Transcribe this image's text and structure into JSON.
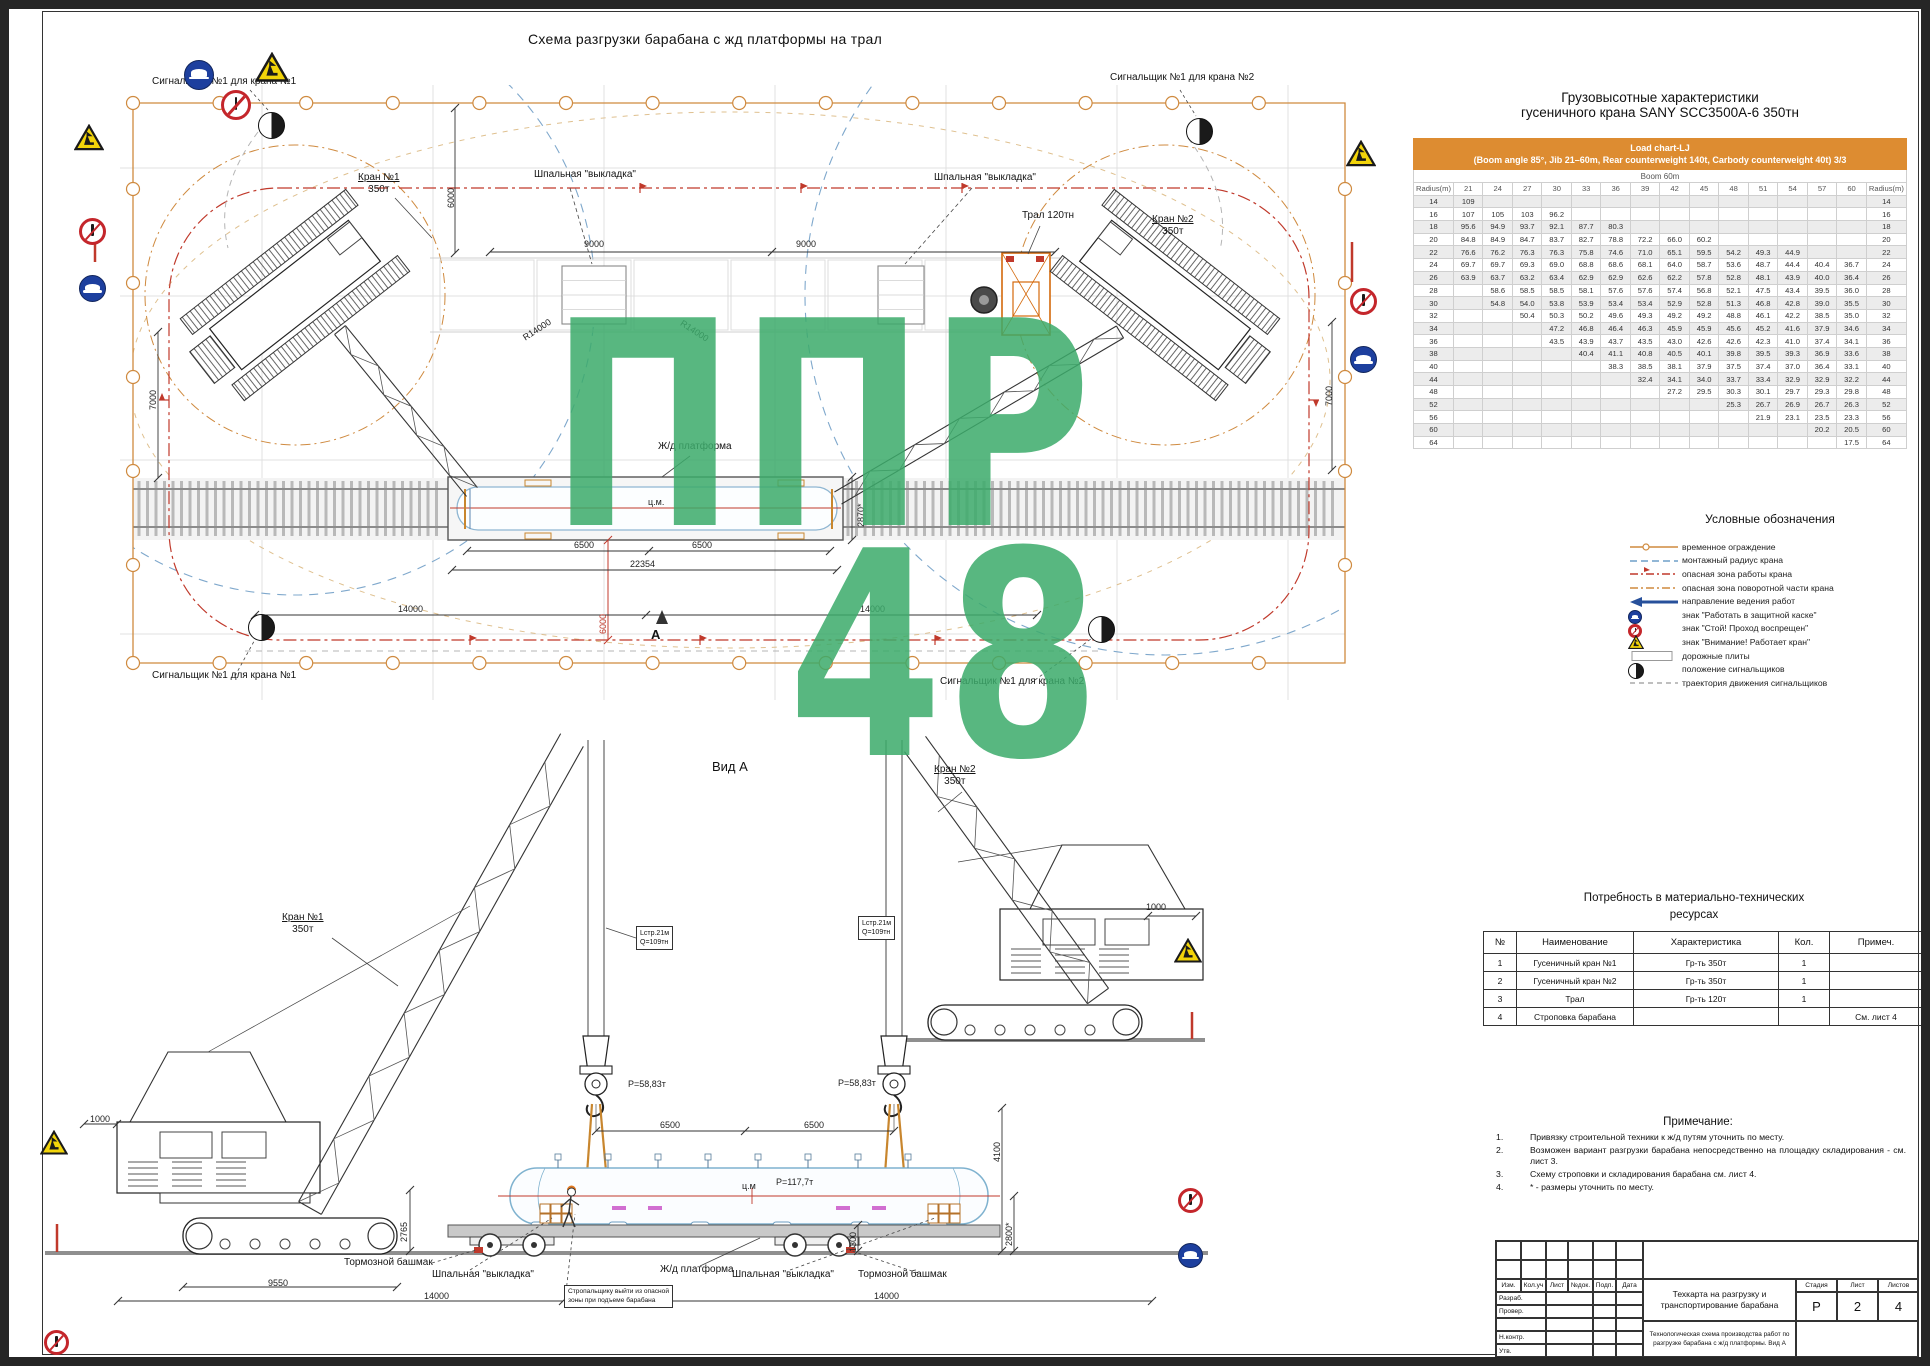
{
  "title": "Схема разгрузки барабана с жд платформы на трал",
  "watermark": {
    "line1": "ППР",
    "line2": "48"
  },
  "plan": {
    "signalman_crane1_top": "Сигнальщик №1 для крана №1",
    "signalman_crane2_top": "Сигнальщик №1 для крана №2",
    "signalman_crane1_bottom": "Сигнальщик №1 для крана №1",
    "signalman_crane2_bottom": "Сигнальщик №1 для крана №2",
    "crane1_line1": "Кран №1",
    "crane1_line2": "350т",
    "crane2_line1": "Кран №2",
    "crane2_line2": "350т",
    "sleeper_label": "Шпальная \"выкладка\"",
    "tral_label": "Трал 120тн",
    "platform_label": "Ж/д платформа",
    "cm_label": "ц.м.",
    "section_marker": "А",
    "dims": {
      "d6000": "6000",
      "d9000": "9000",
      "d7000": "7000",
      "r14000": "R14000",
      "d14000": "14000",
      "d6500": "6500",
      "d22354": "22354",
      "d2870": "2870*",
      "d6000red": "6000"
    }
  },
  "view_a": {
    "title": "Вид А",
    "crane1_line1": "Кран №1",
    "crane1_line2": "350т",
    "crane2_line1": "Кран №2",
    "crane2_line2": "350т",
    "hook_load": "Р=58,83т",
    "sling_line1": "Lстр.21м",
    "sling_line2": "Q=109тн",
    "drum_weight": "Р=117,7т",
    "drum_cm": "ц.м",
    "brake_shoe": "Тормозной башмак",
    "sleeper": "Шпальная \"выкладка\"",
    "platform": "Ж/д платформа",
    "callout_line1": "Стропальщику выйти из опасной",
    "callout_line2": "зоны при подъеме барабана",
    "dims": {
      "d6500": "6500",
      "d4100": "4100",
      "d2800": "2800*",
      "d1300": "1300",
      "d1000": "1000",
      "d2765": "2765",
      "d9550": "9550",
      "d14000": "14000"
    }
  },
  "load_chart": {
    "title_line1": "Грузовысотные характеристики",
    "title_line2": "гусеничного крана SANY SCC3500A-6 350тн",
    "header_line1": "Load chart-LJ",
    "header_line2": "(Boom angle 85°, Jib 21–60m, Rear counterweight 140t, Carbody counterweight 40t) 3/3",
    "boom_label": "Boom 60m",
    "radius_label": "Radius(m)",
    "columns": [
      "21",
      "24",
      "27",
      "30",
      "33",
      "36",
      "39",
      "42",
      "45",
      "48",
      "51",
      "54",
      "57",
      "60"
    ],
    "rows": [
      {
        "radius": "14",
        "values": [
          "109",
          "",
          "",
          "",
          "",
          "",
          "",
          "",
          "",
          "",
          "",
          "",
          "",
          ""
        ]
      },
      {
        "radius": "16",
        "values": [
          "107",
          "105",
          "103",
          "96.2",
          "",
          "",
          "",
          "",
          "",
          "",
          "",
          "",
          "",
          ""
        ]
      },
      {
        "radius": "18",
        "values": [
          "95.6",
          "94.9",
          "93.7",
          "92.1",
          "87.7",
          "80.3",
          "",
          "",
          "",
          "",
          "",
          "",
          "",
          ""
        ]
      },
      {
        "radius": "20",
        "values": [
          "84.8",
          "84.9",
          "84.7",
          "83.7",
          "82.7",
          "78.8",
          "72.2",
          "66.0",
          "60.2",
          "",
          "",
          "",
          "",
          ""
        ]
      },
      {
        "radius": "22",
        "values": [
          "76.6",
          "76.2",
          "76.3",
          "76.3",
          "75.8",
          "74.6",
          "71.0",
          "65.1",
          "59.5",
          "54.2",
          "49.3",
          "44.9",
          "",
          ""
        ]
      },
      {
        "radius": "24",
        "values": [
          "69.7",
          "69.7",
          "69.3",
          "69.0",
          "68.8",
          "68.6",
          "68.1",
          "64.0",
          "58.7",
          "53.6",
          "48.7",
          "44.4",
          "40.4",
          "36.7"
        ]
      },
      {
        "radius": "26",
        "values": [
          "63.9",
          "63.7",
          "63.2",
          "63.4",
          "62.9",
          "62.9",
          "62.6",
          "62.2",
          "57.8",
          "52.8",
          "48.1",
          "43.9",
          "40.0",
          "36.4"
        ]
      },
      {
        "radius": "28",
        "values": [
          "",
          "58.6",
          "58.5",
          "58.5",
          "58.1",
          "57.6",
          "57.6",
          "57.4",
          "56.8",
          "52.1",
          "47.5",
          "43.4",
          "39.5",
          "36.0"
        ]
      },
      {
        "radius": "30",
        "values": [
          "",
          "54.8",
          "54.0",
          "53.8",
          "53.9",
          "53.4",
          "53.4",
          "52.9",
          "52.8",
          "51.3",
          "46.8",
          "42.8",
          "39.0",
          "35.5"
        ]
      },
      {
        "radius": "32",
        "values": [
          "",
          "",
          "50.4",
          "50.3",
          "50.2",
          "49.6",
          "49.3",
          "49.2",
          "49.2",
          "48.8",
          "46.1",
          "42.2",
          "38.5",
          "35.0"
        ]
      },
      {
        "radius": "34",
        "values": [
          "",
          "",
          "",
          "47.2",
          "46.8",
          "46.4",
          "46.3",
          "45.9",
          "45.9",
          "45.6",
          "45.2",
          "41.6",
          "37.9",
          "34.6"
        ]
      },
      {
        "radius": "36",
        "values": [
          "",
          "",
          "",
          "43.5",
          "43.9",
          "43.7",
          "43.5",
          "43.0",
          "42.6",
          "42.6",
          "42.3",
          "41.0",
          "37.4",
          "34.1"
        ]
      },
      {
        "radius": "38",
        "values": [
          "",
          "",
          "",
          "",
          "40.4",
          "41.1",
          "40.8",
          "40.5",
          "40.1",
          "39.8",
          "39.5",
          "39.3",
          "36.9",
          "33.6"
        ]
      },
      {
        "radius": "40",
        "values": [
          "",
          "",
          "",
          "",
          "",
          "38.3",
          "38.5",
          "38.1",
          "37.9",
          "37.5",
          "37.4",
          "37.0",
          "36.4",
          "33.1"
        ]
      },
      {
        "radius": "44",
        "values": [
          "",
          "",
          "",
          "",
          "",
          "",
          "32.4",
          "34.1",
          "34.0",
          "33.7",
          "33.4",
          "32.9",
          "32.9",
          "32.2"
        ]
      },
      {
        "radius": "48",
        "values": [
          "",
          "",
          "",
          "",
          "",
          "",
          "",
          "27.2",
          "29.5",
          "30.3",
          "30.1",
          "29.7",
          "29.3",
          "29.8"
        ]
      },
      {
        "radius": "52",
        "values": [
          "",
          "",
          "",
          "",
          "",
          "",
          "",
          "",
          "",
          "25.3",
          "26.7",
          "26.9",
          "26.7",
          "26.3"
        ]
      },
      {
        "radius": "56",
        "values": [
          "",
          "",
          "",
          "",
          "",
          "",
          "",
          "",
          "",
          "",
          "21.9",
          "23.1",
          "23.5",
          "23.3"
        ]
      },
      {
        "radius": "60",
        "values": [
          "",
          "",
          "",
          "",
          "",
          "",
          "",
          "",
          "",
          "",
          "",
          "",
          "20.2",
          "20.5"
        ]
      },
      {
        "radius": "64",
        "values": [
          "",
          "",
          "",
          "",
          "",
          "",
          "",
          "",
          "",
          "",
          "",
          "",
          "",
          "17.5"
        ]
      }
    ]
  },
  "legend": {
    "title": "Условные обозначения",
    "items": [
      {
        "icon": "fence-line-icon",
        "label": "временное ограждение"
      },
      {
        "icon": "blue-dash-icon",
        "label": "монтажный радиус крана"
      },
      {
        "icon": "red-dashdot-icon",
        "label": "опасная зона работы крана"
      },
      {
        "icon": "orange-dashdot-icon",
        "label": "опасная зона поворотной части крана"
      },
      {
        "icon": "direction-arrow-icon",
        "label": "направление ведения работ"
      },
      {
        "icon": "helmet-sign-icon",
        "label": "знак \"Работать в защитной каске\""
      },
      {
        "icon": "stop-sign-icon",
        "label": "знак \"Стой! Проход воспрещен\""
      },
      {
        "icon": "crane-warning-sign-icon",
        "label": "знак \"Внимание! Работает кран\""
      },
      {
        "icon": "road-plate-icon",
        "label": "дорожные плиты"
      },
      {
        "icon": "signalman-icon",
        "label": "положение сигнальщиков"
      },
      {
        "icon": "gray-dash-icon",
        "label": "траектория движения сигнальщиков"
      }
    ]
  },
  "resources": {
    "title_line1": "Потребность в материально-технических",
    "title_line2": "ресурсах",
    "headers": [
      "№",
      "Наименование",
      "Характеристика",
      "Кол.",
      "Примеч."
    ],
    "rows": [
      [
        "1",
        "Гусеничный кран №1",
        "Гр-ть 350т",
        "1",
        ""
      ],
      [
        "2",
        "Гусеничный кран №2",
        "Гр-ть 350т",
        "1",
        ""
      ],
      [
        "3",
        "Трал",
        "Гр-ть 120т",
        "1",
        ""
      ],
      [
        "4",
        "Строповка барабана",
        "",
        "",
        "См. лист 4"
      ]
    ]
  },
  "notes": {
    "title": "Примечание:",
    "items": [
      "Привязку строительной техники к ж/д путям уточнить по месту.",
      "Возможен вариант разгрузки барабана непосредственно на площадку складирования - см. лист 3.",
      "Схему строповки и складирования барабана см. лист 4.",
      "* - размеры уточнить по месту."
    ]
  },
  "titleblock": {
    "cols": [
      "Изм.",
      "Кол.уч",
      "Лист",
      "№док.",
      "Подп.",
      "Дата"
    ],
    "rows": [
      "Разраб.",
      "Провер.",
      "",
      "Н.контр.",
      "Утв."
    ],
    "doc_title": "Техкарта на разгрузку и транспортирование барабана",
    "sheet_title": "Технологическая схема производства работ по разгрузке барабана с ж/д платформы. Вид А",
    "stage_headers": [
      "Стадия",
      "Лист",
      "Листов"
    ],
    "stage_values": [
      "Р",
      "2",
      "4"
    ]
  }
}
